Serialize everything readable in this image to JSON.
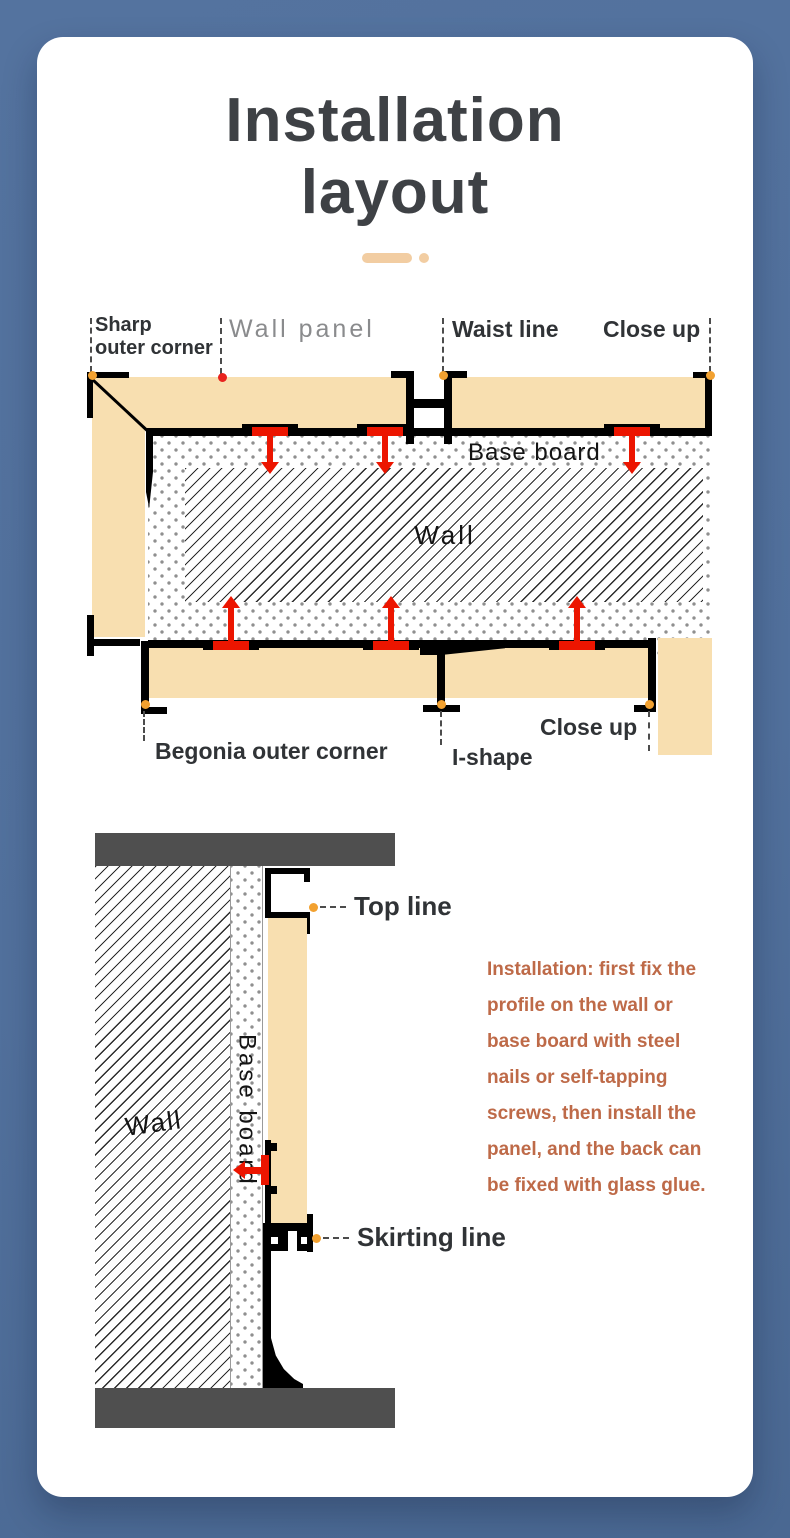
{
  "title": {
    "line1": "Installation",
    "line2": "layout"
  },
  "diagram1": {
    "labels": {
      "sharp_outer_corner_lines": [
        "Sharp",
        "outer corner"
      ],
      "wall_panel": "Wall panel",
      "waist_line": "Waist line",
      "close_up_top": "Close up",
      "base_board": "Base board",
      "wall": "Wall",
      "begonia_outer_corner": "Begonia outer corner",
      "i_shape": "I-shape",
      "close_up_bottom": "Close up"
    }
  },
  "diagram2": {
    "labels": {
      "top_line": "Top line",
      "skirting_line": "Skirting line",
      "wall": "Wall",
      "base_board": "Base board"
    }
  },
  "instructions": {
    "lines": [
      "Installation: first fix the",
      "profile on the wall or",
      "base board with steel",
      "nails or self-tapping",
      "screws, then install the",
      "panel, and the back can",
      "be fixed with glass glue."
    ]
  },
  "colors": {
    "background": "#51709C",
    "card": "#FFFFFF",
    "panel_tan": "#F8DFB0",
    "profile_black": "#000000",
    "clip_red": "#EC1500",
    "marker_orange": "#F2A130",
    "marker_red": "#E8231E",
    "ceiling_floor_gray": "#4F4F4F",
    "accent_peach": "#F2CDA2",
    "instruction_text": "#BE6A48",
    "title_text": "#3E4145",
    "label_text": "#303336",
    "muted_label": "#8A8B8D"
  }
}
